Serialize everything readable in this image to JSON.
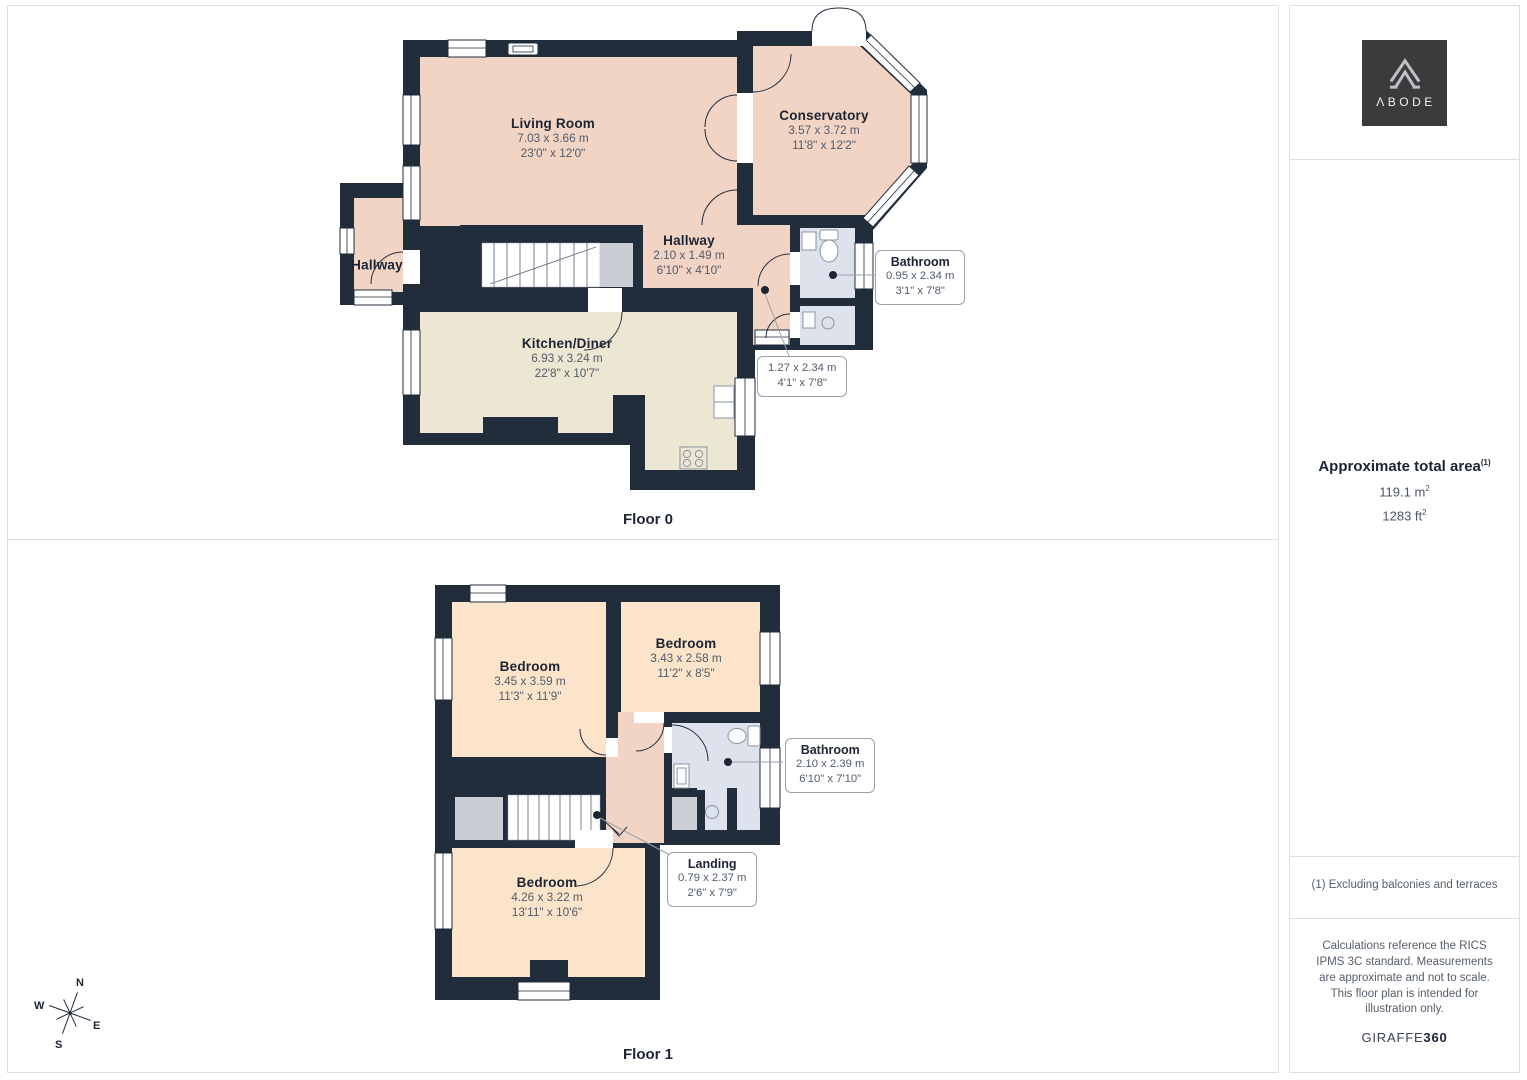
{
  "colors": {
    "wall": "#222d3c",
    "room_pink": "#f2d4c5",
    "room_cream": "#ece7d2",
    "room_peach": "#fbe4c9",
    "bathroom_blue": "#dee2ec",
    "stair_gray": "#c9cdd3",
    "divider": "#dcdee1",
    "text_dark": "#1d2433",
    "text_gray": "#525c6b",
    "logo_bg": "#3b3b3d"
  },
  "floor0": {
    "label": "Floor 0",
    "entrance_arrow": "→",
    "rooms": {
      "living": {
        "name": "Living Room",
        "metric": "7.03 x 3.66 m",
        "imperial": "23'0\" x 12'0\""
      },
      "conservatory": {
        "name": "Conservatory",
        "metric": "3.57 x 3.72 m",
        "imperial": "11'8\" x 12'2\""
      },
      "hallway_left": {
        "name": "Hallway"
      },
      "hallway": {
        "name": "Hallway",
        "metric": "2.10 x 1.49 m",
        "imperial": "6'10\" x 4'10\""
      },
      "kitchen": {
        "name": "Kitchen/Diner",
        "metric": "6.93 x 3.24 m",
        "imperial": "22'8\" x 10'7\""
      }
    },
    "callouts": {
      "bathroom": {
        "name": "Bathroom",
        "metric": "0.95 x 2.34 m",
        "imperial": "3'1\" x 7'8\""
      },
      "corridor": {
        "metric": "1.27 x 2.34 m",
        "imperial": "4'1\" x 7'8\""
      }
    }
  },
  "floor1": {
    "label": "Floor 1",
    "rooms": {
      "bedroom1": {
        "name": "Bedroom",
        "metric": "3.45 x 3.59 m",
        "imperial": "11'3\" x 11'9\""
      },
      "bedroom2": {
        "name": "Bedroom",
        "metric": "3.43 x 2.58 m",
        "imperial": "11'2\" x 8'5\""
      },
      "bedroom3": {
        "name": "Bedroom",
        "metric": "4.26 x 3.22 m",
        "imperial": "13'11\" x 10'6\""
      }
    },
    "callouts": {
      "bathroom": {
        "name": "Bathroom",
        "metric": "2.10 x 2.39 m",
        "imperial": "6'10\" x 7'10\""
      },
      "landing": {
        "name": "Landing",
        "metric": "0.79 x 2.37 m",
        "imperial": "2'6\" x 7'9\""
      }
    }
  },
  "sidebar": {
    "brand": "ΛBODE",
    "area_title": "Approximate total area",
    "area_title_sup": "(1)",
    "area_metric": "119.1 m",
    "area_metric_sup": "2",
    "area_imperial": "1283 ft",
    "area_imperial_sup": "2",
    "footnote": "(1) Excluding balconies and terraces",
    "disclaimer": "Calculations reference the RICS IPMS 3C standard. Measurements are approximate and not to scale. This floor plan is intended for illustration only.",
    "brand_footer_regular": "GIRAFFE",
    "brand_footer_bold": "360"
  },
  "compass": {
    "n": "N",
    "e": "E",
    "s": "S",
    "w": "W"
  }
}
